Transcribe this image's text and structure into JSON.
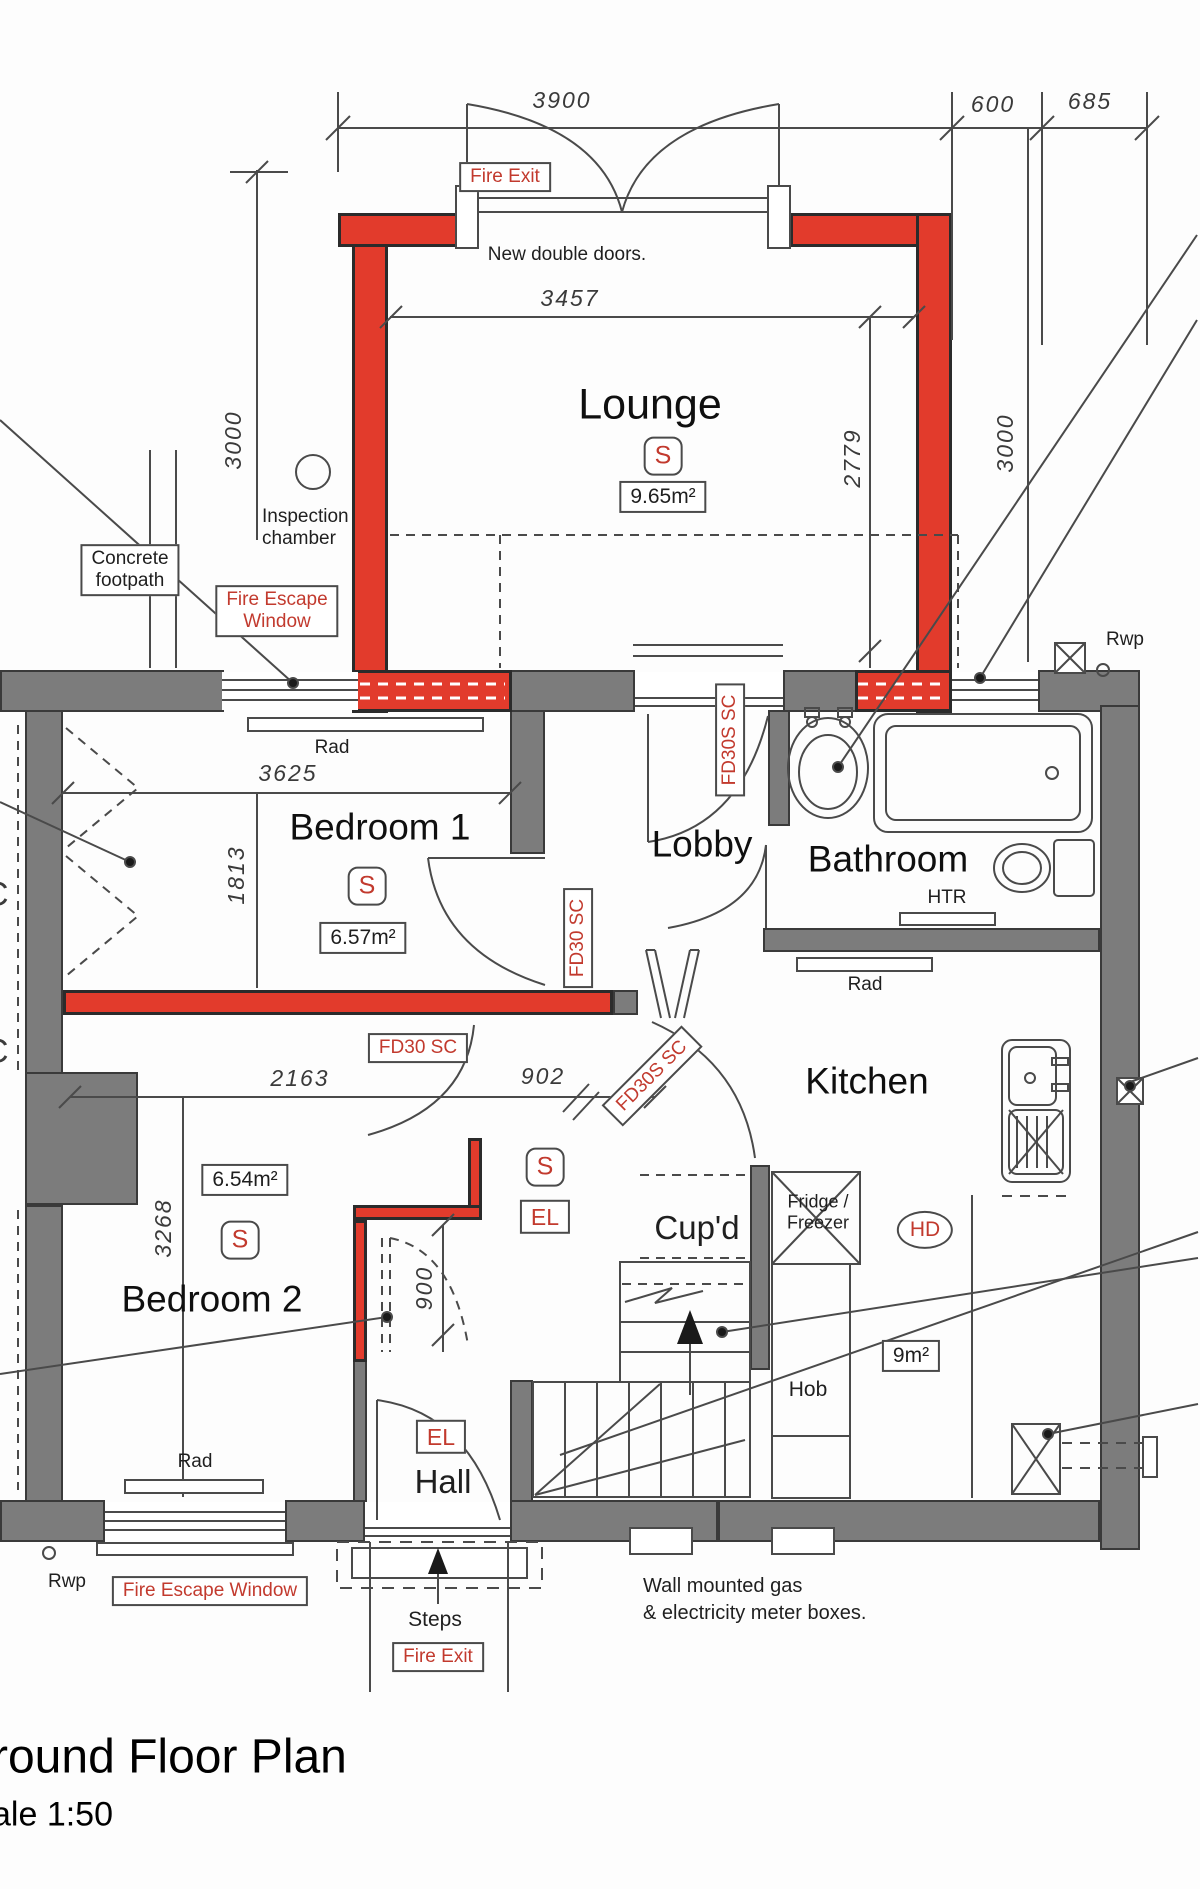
{
  "title": {
    "heading": "round Floor Plan",
    "scale": "ale 1:50"
  },
  "dims": {
    "w3900": "3900",
    "w600": "600",
    "w685": "685",
    "w3457": "3457",
    "h2779": "2779",
    "h3000_left": "3000",
    "h3000_right": "3000",
    "w3625": "3625",
    "h1813": "1813",
    "w2163": "2163",
    "w902": "902",
    "h900": "900",
    "h3268": "3268"
  },
  "rooms": {
    "lounge": "Lounge",
    "bedroom1": "Bedroom 1",
    "bedroom2": "Bedroom 2",
    "lobby": "Lobby",
    "bathroom": "Bathroom",
    "kitchen": "Kitchen",
    "cupboard": "Cup'd",
    "hall": "Hall"
  },
  "areas": {
    "lounge": "9.65m²",
    "bedroom1": "6.57m²",
    "bedroom2": "6.54m²",
    "kitchen": "9m²"
  },
  "safety": {
    "fire_exit": "Fire Exit",
    "fire_escape_line1": "Fire Escape",
    "fire_escape_line2": "Window",
    "fire_escape_window": "Fire Escape Window"
  },
  "doors": {
    "new_double_doors": "New double doors.",
    "fd30": "FD30 SC",
    "fd30s": "FD30S SC"
  },
  "symbols": {
    "smoke": "S",
    "el": "EL",
    "hd": "HD",
    "htr": "HTR",
    "rad": "Rad",
    "rwp": "Rwp",
    "hob": "Hob",
    "steps": "Steps",
    "fridge_line1": "Fridge /",
    "fridge_line2": "Freezer",
    "edge_letter": "C"
  },
  "annotations": {
    "inspection_line1": "Inspection",
    "inspection_line2": "chamber",
    "concrete_line1": "Concrete",
    "concrete_line2": "footpath",
    "meters_line1": "Wall mounted gas",
    "meters_line2": "& electricity meter boxes."
  },
  "colors": {
    "wall_gray": "#7c7c7c",
    "wall_red": "#e23b2c",
    "accent_red": "#c23a2e",
    "ink": "#1f1f1f",
    "line": "#4a4a4a"
  }
}
